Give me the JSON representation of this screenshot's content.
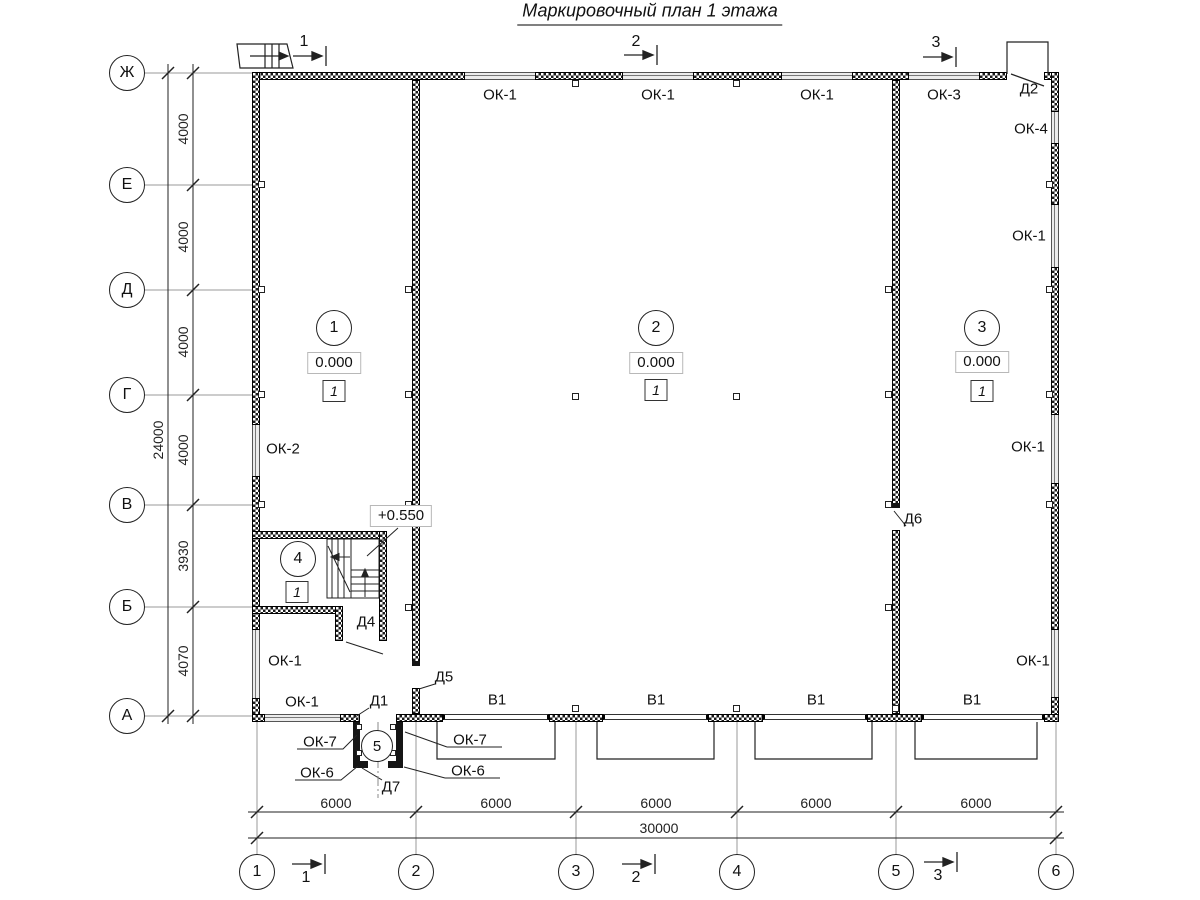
{
  "title": "Маркировочный план 1 этажа",
  "axes": {
    "rows": [
      "Ж",
      "Е",
      "Д",
      "Г",
      "В",
      "Б",
      "А"
    ],
    "cols": [
      "1",
      "2",
      "3",
      "4",
      "5",
      "6"
    ]
  },
  "dims": {
    "left": [
      "4000",
      "4000",
      "4000",
      "4000",
      "3930",
      "4070"
    ],
    "left_total": "24000",
    "bottom": [
      "6000",
      "6000",
      "6000",
      "6000",
      "6000"
    ],
    "bottom_total": "30000"
  },
  "sections": {
    "top": [
      "1",
      "2",
      "3"
    ],
    "bottom": [
      "1",
      "2",
      "3"
    ]
  },
  "rooms": {
    "r1": {
      "num": "1",
      "elev": "0.000",
      "finish": "1"
    },
    "r2": {
      "num": "2",
      "elev": "0.000",
      "finish": "1"
    },
    "r3": {
      "num": "3",
      "elev": "0.000",
      "finish": "1"
    },
    "r4": {
      "num": "4",
      "finish": "1"
    },
    "r5": {
      "num": "5"
    },
    "stair_elev": "+0.550"
  },
  "labels": {
    "ok1_top_1": "ОК-1",
    "ok1_top_2": "ОК-1",
    "ok1_top_3": "ОК-1",
    "ok3": "ОК-3",
    "d2": "Д2",
    "ok4": "ОК-4",
    "ok1_right_1": "ОК-1",
    "ok1_right_2": "ОК-1",
    "ok1_right_3": "ОК-1",
    "ok2": "ОК-2",
    "ok1_left": "ОК-1",
    "ok1_bottom": "ОК-1",
    "d1": "Д1",
    "d5": "Д5",
    "d6": "Д6",
    "d4": "Д4",
    "d7": "Д7",
    "v1_1": "В1",
    "v1_2": "В1",
    "v1_3": "В1",
    "v1_4": "В1",
    "ok7_left": "ОК-7",
    "ok7_right": "ОК-7",
    "ok6_left": "ОК-6",
    "ok6_right": "ОК-6"
  }
}
